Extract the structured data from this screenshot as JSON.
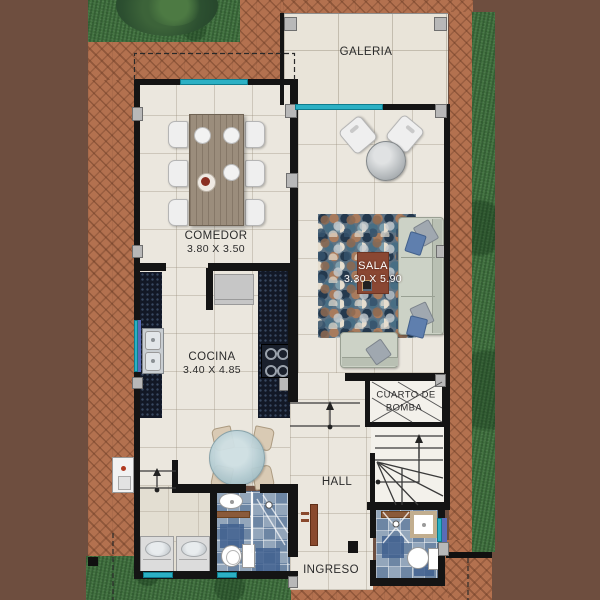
{
  "rooms": {
    "galeria": {
      "name": "GALERIA"
    },
    "comedor": {
      "name": "COMEDOR",
      "dims": "3.80 X 3.50"
    },
    "sala": {
      "name": "SALA",
      "dims": "3.30 X 5.90"
    },
    "cocina": {
      "name": "COCINA",
      "dims": "3.40 X 4.85"
    },
    "cuarto_de_bomba": {
      "name_line1": "CUARTO DE",
      "name_line2": "BOMBA"
    },
    "hall": {
      "name": "HALL"
    },
    "ingreso": {
      "name": "INGRESO"
    }
  },
  "colors": {
    "background_brown": "#6e4e3f",
    "brick_patio": "#b3714f",
    "grass": "#41713f",
    "floor_tile": "#ebe7de",
    "wall": "#141414",
    "window_cyan": "#2cb0c4",
    "counter_granite": "#121826",
    "sala_label_box": "#8a4733",
    "sofa": "#ccd2c6",
    "pillow_blue": "#5f7fae",
    "bath_tile_blue": "#7f94ac",
    "entry_door_wood": "#8a4a2e"
  }
}
